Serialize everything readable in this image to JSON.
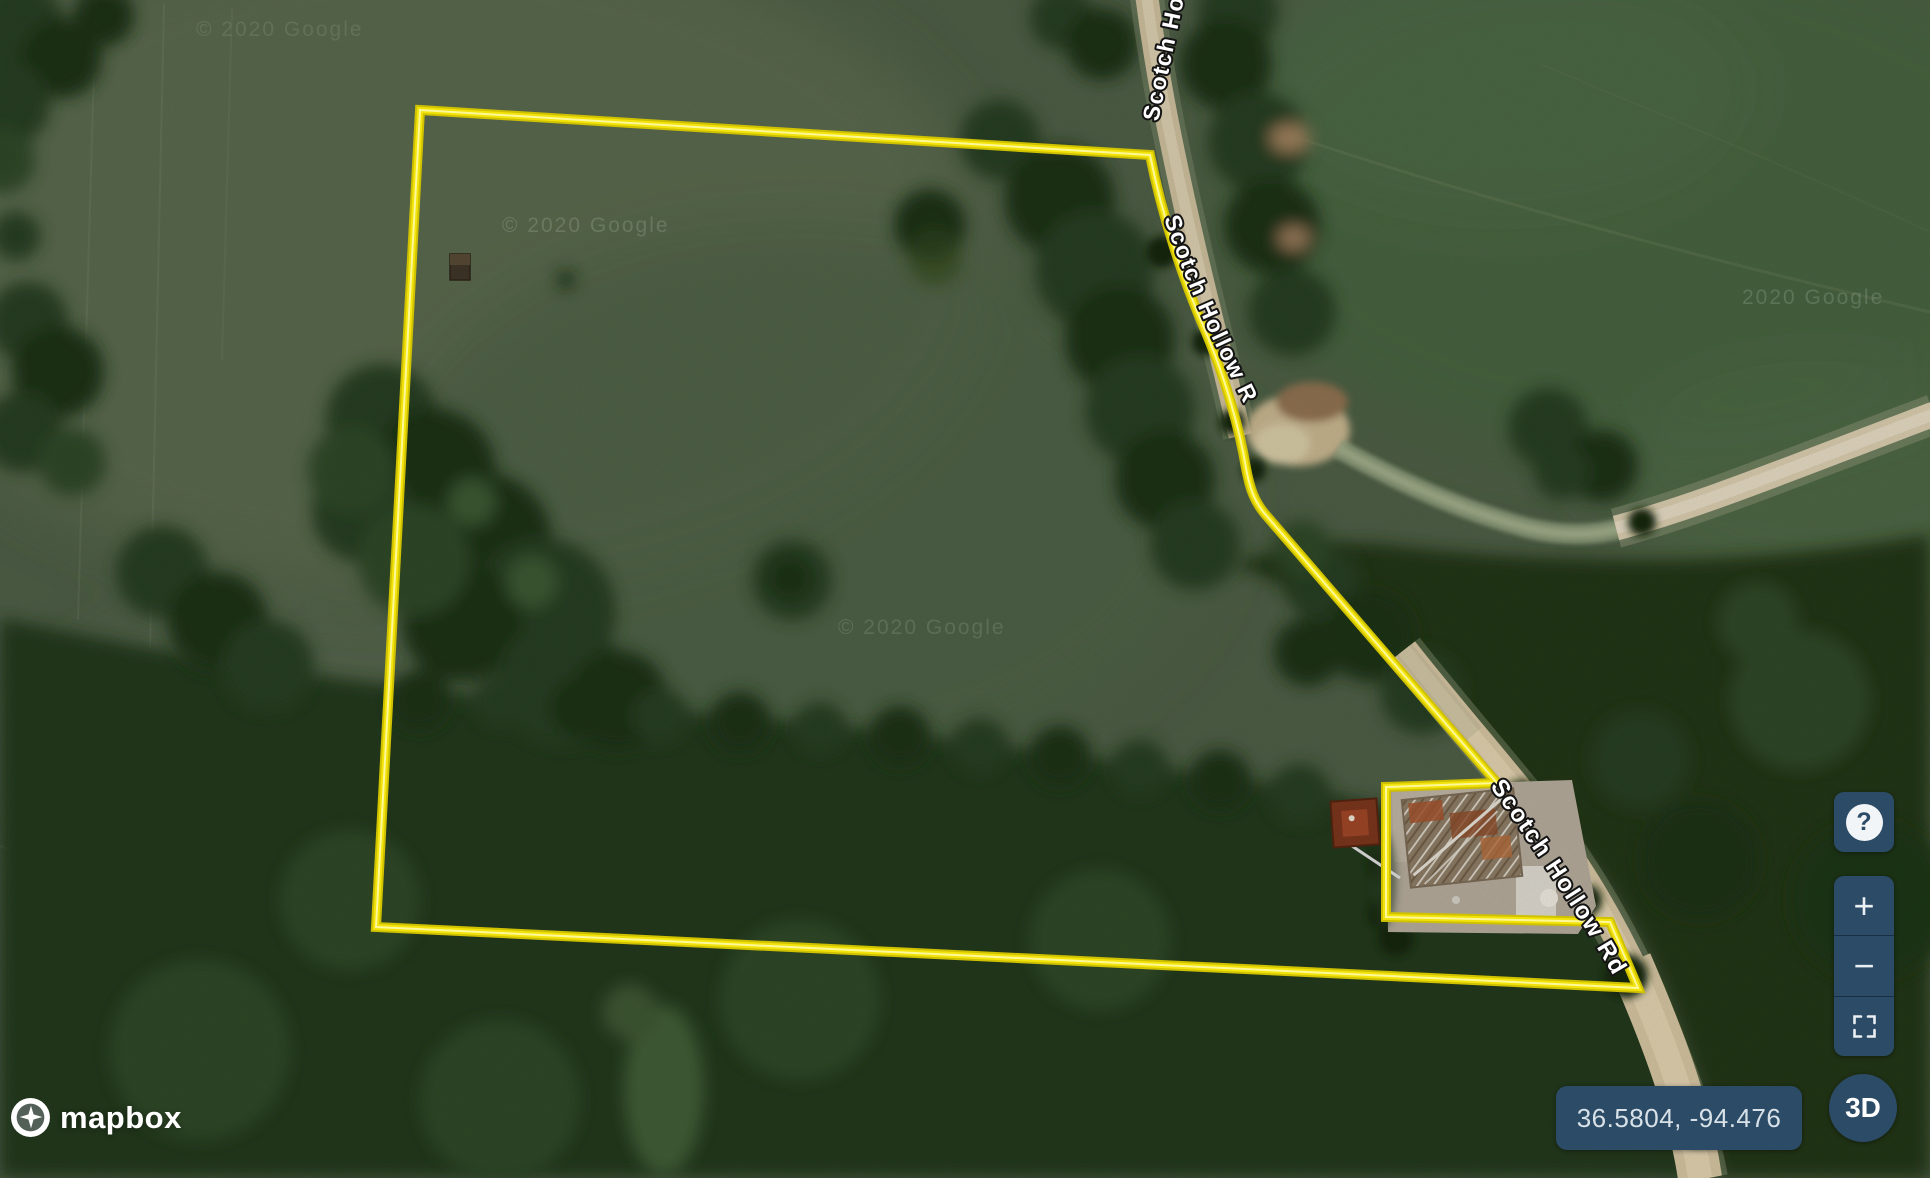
{
  "map": {
    "road_labels": [
      {
        "text": "Scotch Hollow Rd"
      },
      {
        "text": "Scotch Hollow Rd"
      },
      {
        "text": "Scotch Hollow Rd"
      }
    ],
    "watermarks": [
      {
        "text": "© 2020 Google"
      },
      {
        "text": "© 2020 Google"
      },
      {
        "text": "© 2020 Google"
      },
      {
        "text": "2020 Google"
      }
    ],
    "coordinates_readout": "36.5804, -94.476",
    "colors": {
      "boundary_yellow": "#f2e30b",
      "control_background": "#2b4b66",
      "control_foreground": "#e9eff3",
      "field_green": "#4d5d45",
      "forest_green": "#22381e",
      "road_tan": "#d2c2a0"
    }
  },
  "controls": {
    "help_label": "?",
    "zoom_in_label": "+",
    "zoom_out_label": "−",
    "threed_label": "3D"
  },
  "attribution": {
    "wordmark": "mapbox"
  }
}
